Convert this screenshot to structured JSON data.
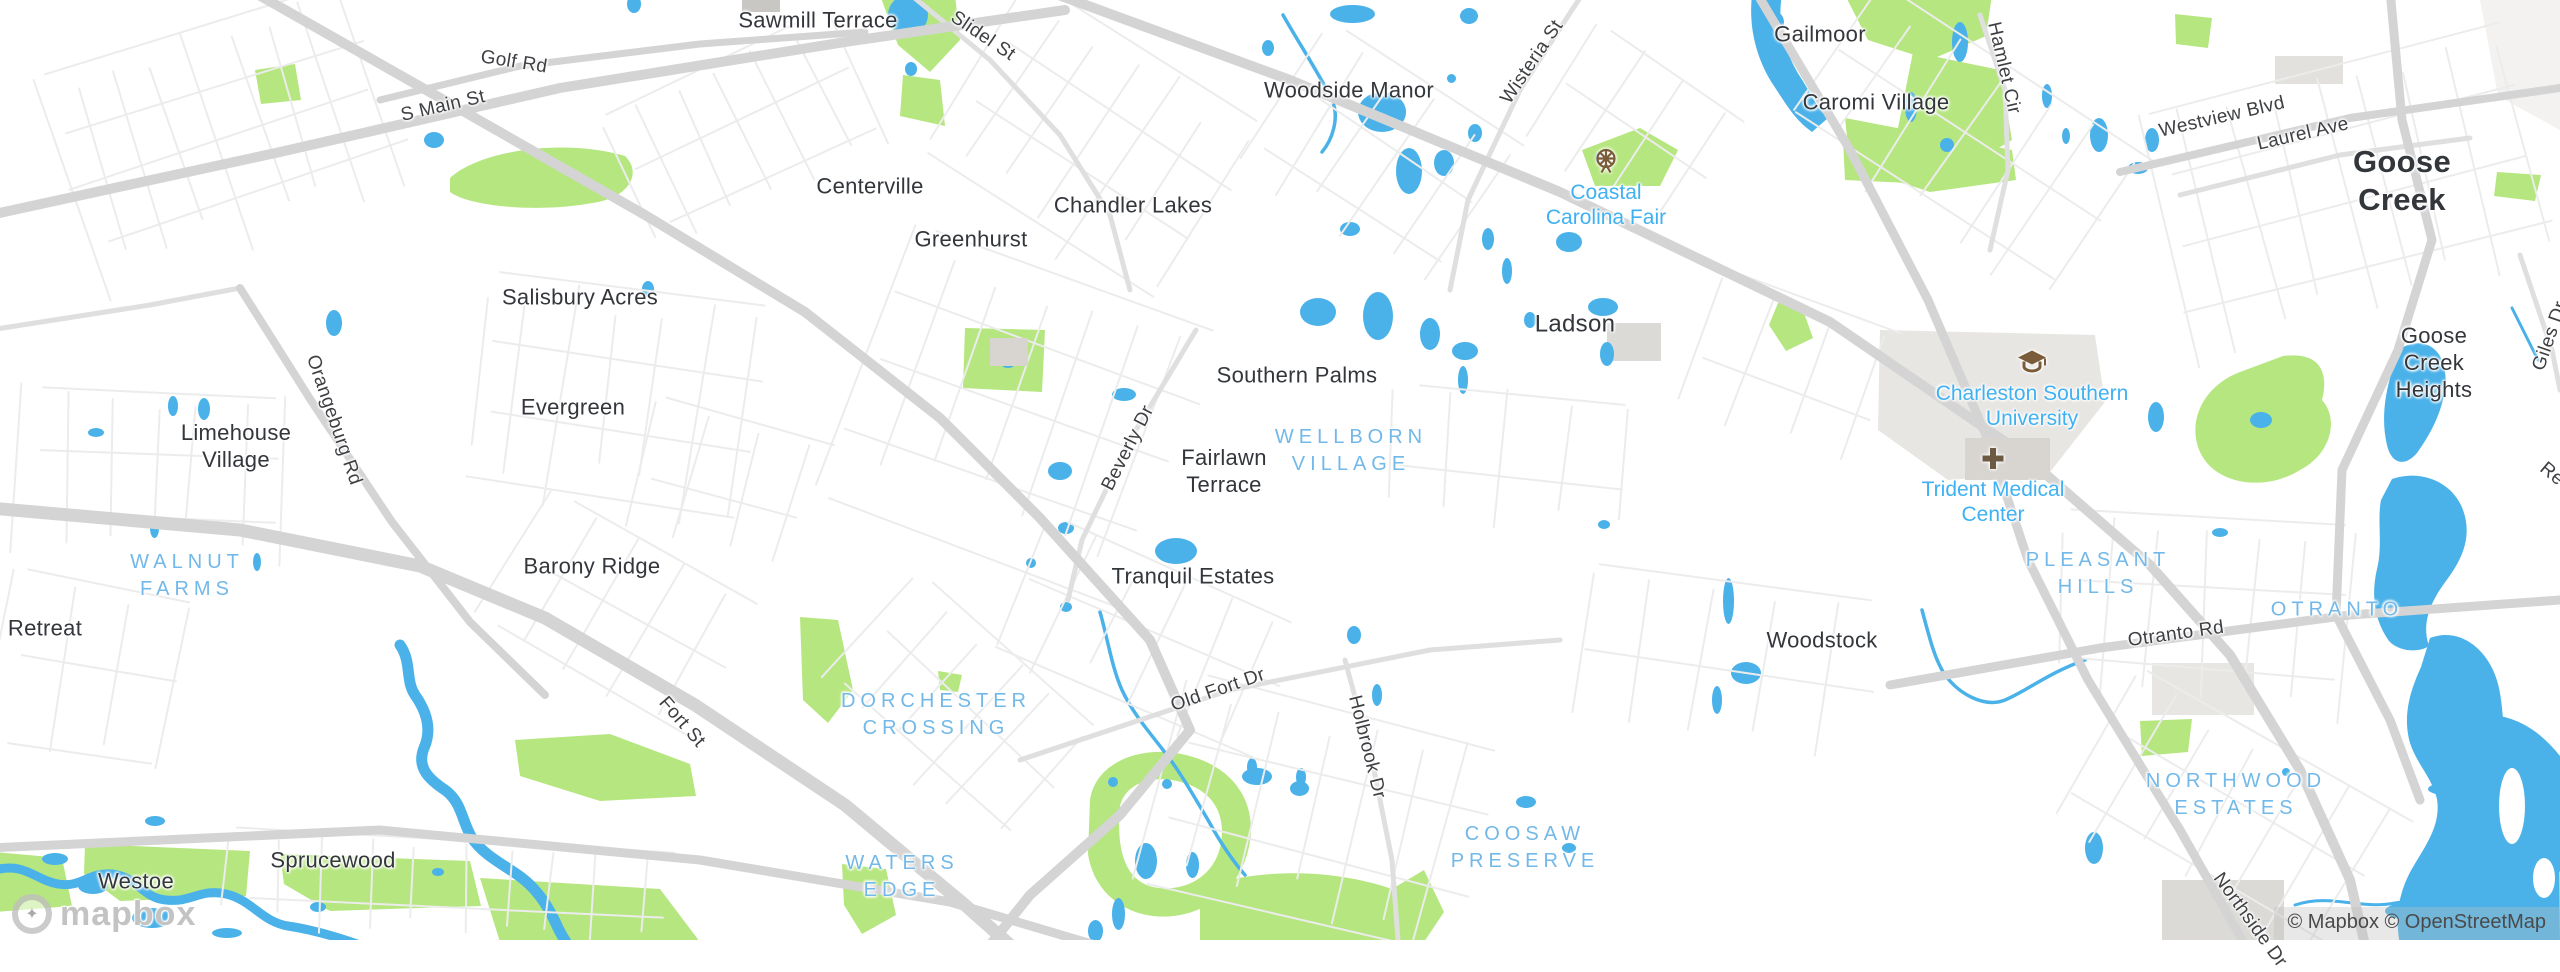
{
  "map": {
    "attribution": "© Mapbox © OpenStreetMap",
    "logo": "mapbox",
    "colors": {
      "water": "#4ab2e9",
      "park": "#b6e67f",
      "road_major": "#d4d4d4",
      "road_minor": "#ececec",
      "landuse_gray": "#e8e6e3",
      "building_gray": "#d8d5d1",
      "city_text": "#33363b",
      "neighborhood_blue": "#72b8e8",
      "poi_blue": "#3fb1f2",
      "poi_icon_brown": "#7a5b3a"
    },
    "labels": {
      "cities": [
        {
          "text": "Sawmill Terrace",
          "x": 818,
          "y": 21
        },
        {
          "text": "Woodside Manor",
          "x": 1349,
          "y": 91
        },
        {
          "text": "Gailmoor",
          "x": 1820,
          "y": 35
        },
        {
          "text": "Caromi Village",
          "x": 1876,
          "y": 103
        },
        {
          "text": "Centerville",
          "x": 870,
          "y": 187
        },
        {
          "text": "Chandler Lakes",
          "x": 1133,
          "y": 206
        },
        {
          "text": "Greenhurst",
          "x": 971,
          "y": 240
        },
        {
          "text": "Salisbury Acres",
          "x": 580,
          "y": 298
        },
        {
          "text": "Ladson",
          "x": 1575,
          "y": 324,
          "size": 24
        },
        {
          "text": "Goose Creek",
          "x": 2402,
          "y": 181,
          "size": 31,
          "weight": 600
        },
        {
          "text": "Goose Creek\nHeights",
          "x": 2434,
          "y": 363
        },
        {
          "text": "Limehouse\nVillage",
          "x": 236,
          "y": 447
        },
        {
          "text": "Evergreen",
          "x": 573,
          "y": 408
        },
        {
          "text": "Southern Palms",
          "x": 1297,
          "y": 376
        },
        {
          "text": "Fairlawn\nTerrace",
          "x": 1224,
          "y": 472
        },
        {
          "text": "Retreat",
          "x": 45,
          "y": 629
        },
        {
          "text": "Barony Ridge",
          "x": 592,
          "y": 567
        },
        {
          "text": "Tranquil Estates",
          "x": 1193,
          "y": 577
        },
        {
          "text": "Woodstock",
          "x": 1822,
          "y": 641
        },
        {
          "text": "Sprucewood",
          "x": 333,
          "y": 861
        },
        {
          "text": "Westoe",
          "x": 136,
          "y": 882
        }
      ],
      "neighborhoods": [
        {
          "text": "WALNUT\nFARMS",
          "x": 187,
          "y": 576
        },
        {
          "text": "WELLBORN\nVILLAGE",
          "x": 1351,
          "y": 451
        },
        {
          "text": "DORCHESTER\nCROSSING",
          "x": 936,
          "y": 715
        },
        {
          "text": "WATERS\nEDGE",
          "x": 902,
          "y": 877
        },
        {
          "text": "COOSAW\nPRESERVE",
          "x": 1525,
          "y": 848
        },
        {
          "text": "PLEASANT\nHILLS",
          "x": 2098,
          "y": 574
        },
        {
          "text": "OTRANTO",
          "x": 2337,
          "y": 610
        },
        {
          "text": "NORTHWOOD\nESTATES",
          "x": 2236,
          "y": 795
        }
      ],
      "roads": [
        {
          "text": "Golf Rd",
          "x": 514,
          "y": 62,
          "rot": 9
        },
        {
          "text": "S Main St",
          "x": 443,
          "y": 106,
          "rot": -13
        },
        {
          "text": "Slidel St",
          "x": 983,
          "y": 36,
          "rot": 34
        },
        {
          "text": "Wisteria St",
          "x": 1532,
          "y": 62,
          "rot": -56
        },
        {
          "text": "Hamlet Cir",
          "x": 2004,
          "y": 68,
          "rot": 77
        },
        {
          "text": "Westview Blvd",
          "x": 2222,
          "y": 117,
          "rot": -13
        },
        {
          "text": "Laurel Ave",
          "x": 2303,
          "y": 134,
          "rot": -13
        },
        {
          "text": "Orangeburg Rd",
          "x": 334,
          "y": 420,
          "rot": 71
        },
        {
          "text": "Beverly Dr",
          "x": 1128,
          "y": 448,
          "rot": -63
        },
        {
          "text": "Fort St",
          "x": 682,
          "y": 722,
          "rot": 49
        },
        {
          "text": "Old Fort Dr",
          "x": 1218,
          "y": 690,
          "rot": -19
        },
        {
          "text": "Holbrook Dr",
          "x": 1367,
          "y": 747,
          "rot": 76
        },
        {
          "text": "Otranto Rd",
          "x": 2176,
          "y": 634,
          "rot": -8
        },
        {
          "text": "Giles Dr",
          "x": 2550,
          "y": 336,
          "rot": -71
        },
        {
          "text": "Northside Dr",
          "x": 2250,
          "y": 920,
          "rot": 54
        },
        {
          "text": "Re",
          "x": 2552,
          "y": 474,
          "rot": 40
        }
      ],
      "pois": [
        {
          "text": "Coastal\nCarolina Fair",
          "icon": "ferris-wheel",
          "x": 1606,
          "y": 205,
          "icon_y": 163
        },
        {
          "text": "Charleston Southern\nUniversity",
          "icon": "graduation-cap",
          "x": 2032,
          "y": 406,
          "icon_y": 364
        },
        {
          "text": "Trident Medical\nCenter",
          "icon": "hospital-cross",
          "x": 1993,
          "y": 502,
          "icon_y": 461
        }
      ]
    }
  }
}
